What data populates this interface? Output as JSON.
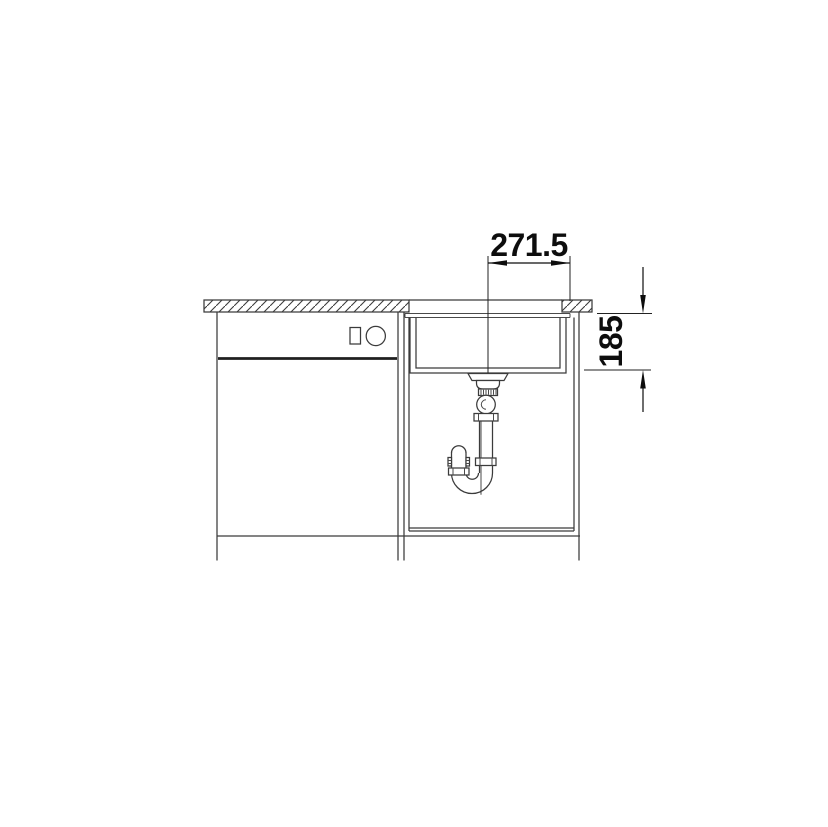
{
  "drawing": {
    "kind": "sink-installation-side-view",
    "background_color": "#ffffff",
    "line_color": "#3b3b3b",
    "dimension_color": "#0d0d0d",
    "dimensions": {
      "drain_to_edge": {
        "value": "271.5"
      },
      "bowl_depth": {
        "value": "185"
      }
    }
  }
}
